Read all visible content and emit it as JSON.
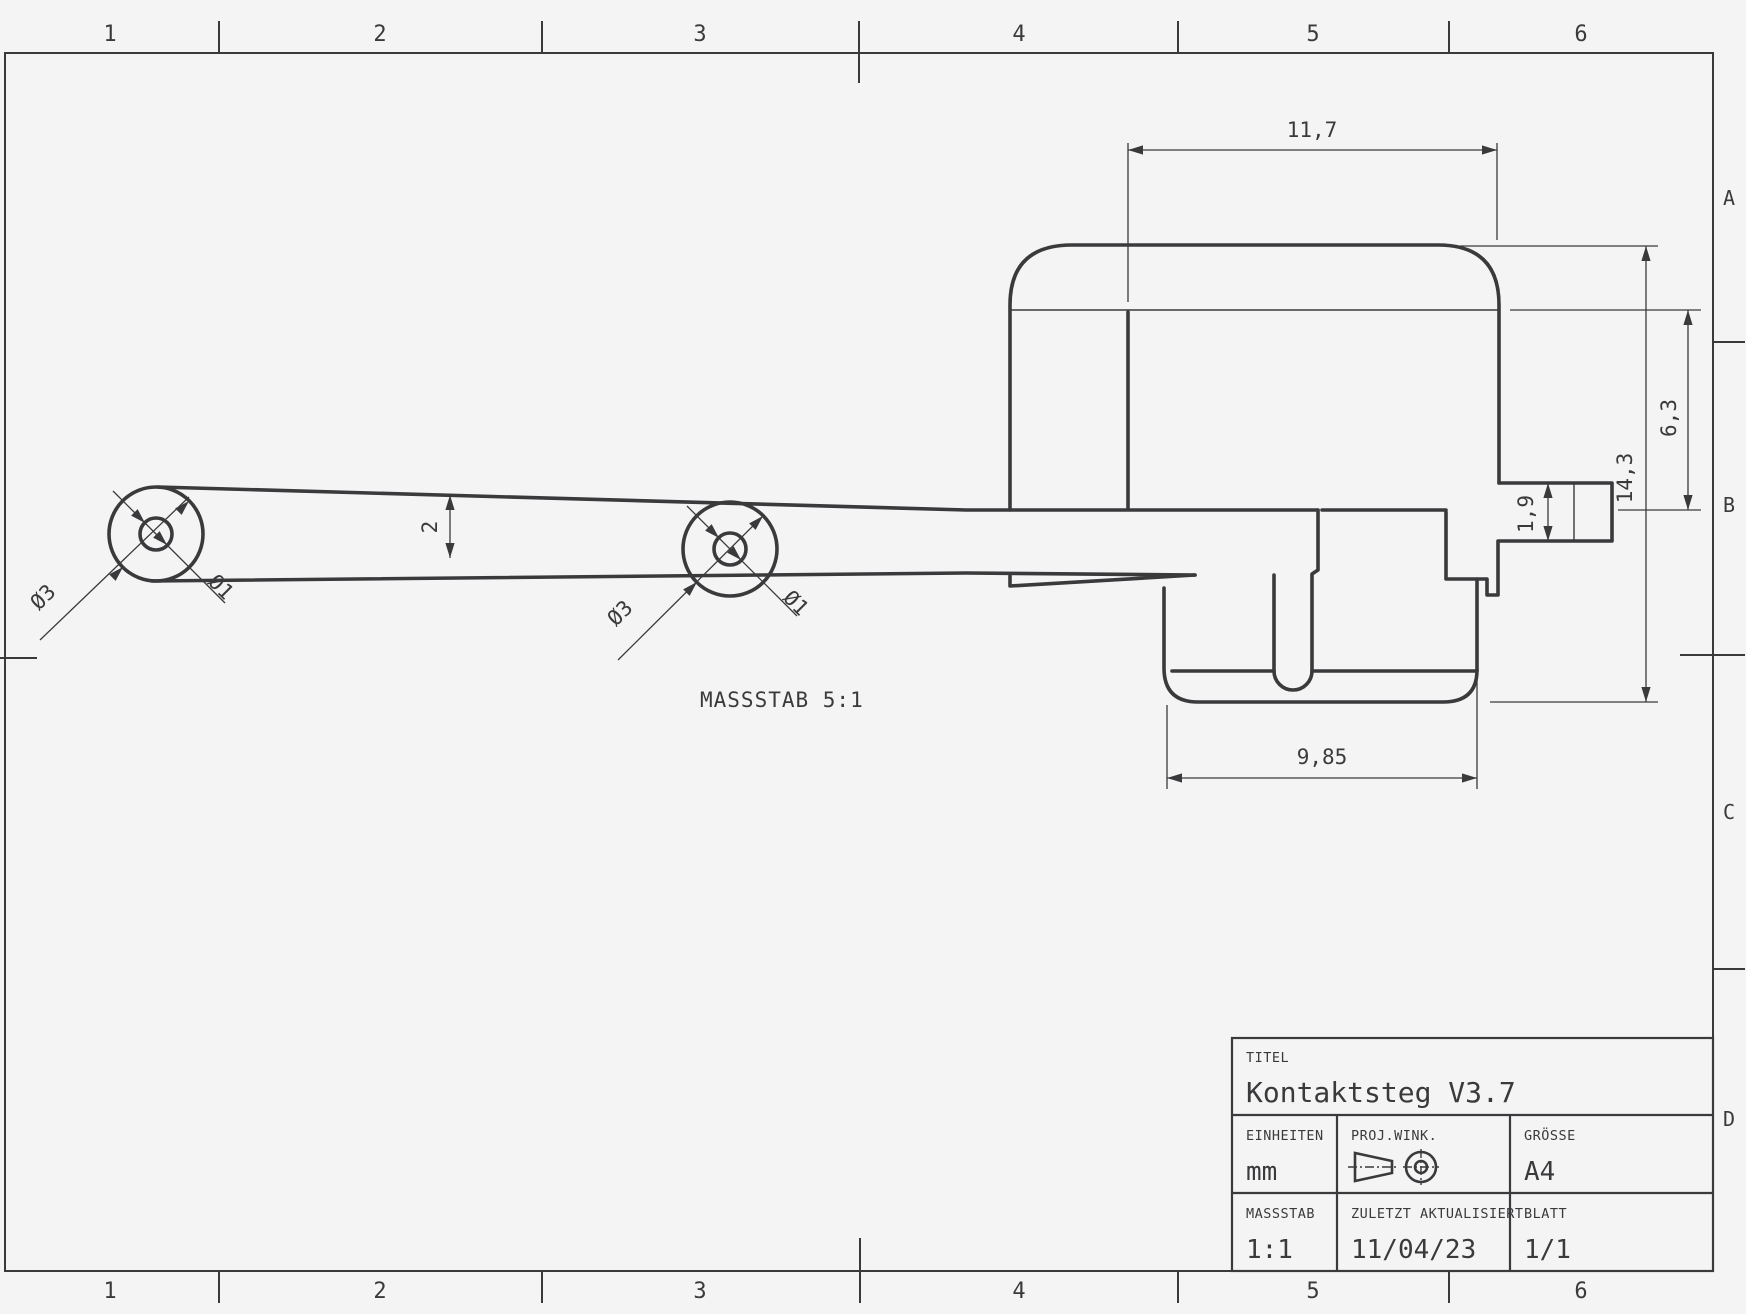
{
  "sheet": {
    "bg": "#f4f4f5",
    "line_color": "#3a3a3c"
  },
  "zones": {
    "cols": [
      "1",
      "2",
      "3",
      "4",
      "5",
      "6"
    ],
    "rows": [
      "A",
      "B",
      "C",
      "D"
    ]
  },
  "view_label": "MASSSTAB 5:1",
  "dims": {
    "top_width": "11,7",
    "overall_height": "14,3",
    "upper_height": "6,3",
    "tab_height": "1,9",
    "flange_width": "9,85",
    "arm_thickness": "2",
    "boss_outer_dia": "Ø3",
    "boss_inner_dia": "Ø1"
  },
  "title_block": {
    "titel_label": "TITEL",
    "titel": "Kontaktsteg V3.7",
    "einheiten_label": "EINHEITEN",
    "einheiten": "mm",
    "proj_label": "PROJ.WINK.",
    "groesse_label": "GRÖSSE",
    "groesse": "A4",
    "massstab_label": "MASSSTAB",
    "massstab": "1:1",
    "updated_label": "ZULETZT AKTUALISIERT",
    "updated": "11/04/23",
    "blatt_label": "BLATT",
    "blatt": "1/1"
  }
}
